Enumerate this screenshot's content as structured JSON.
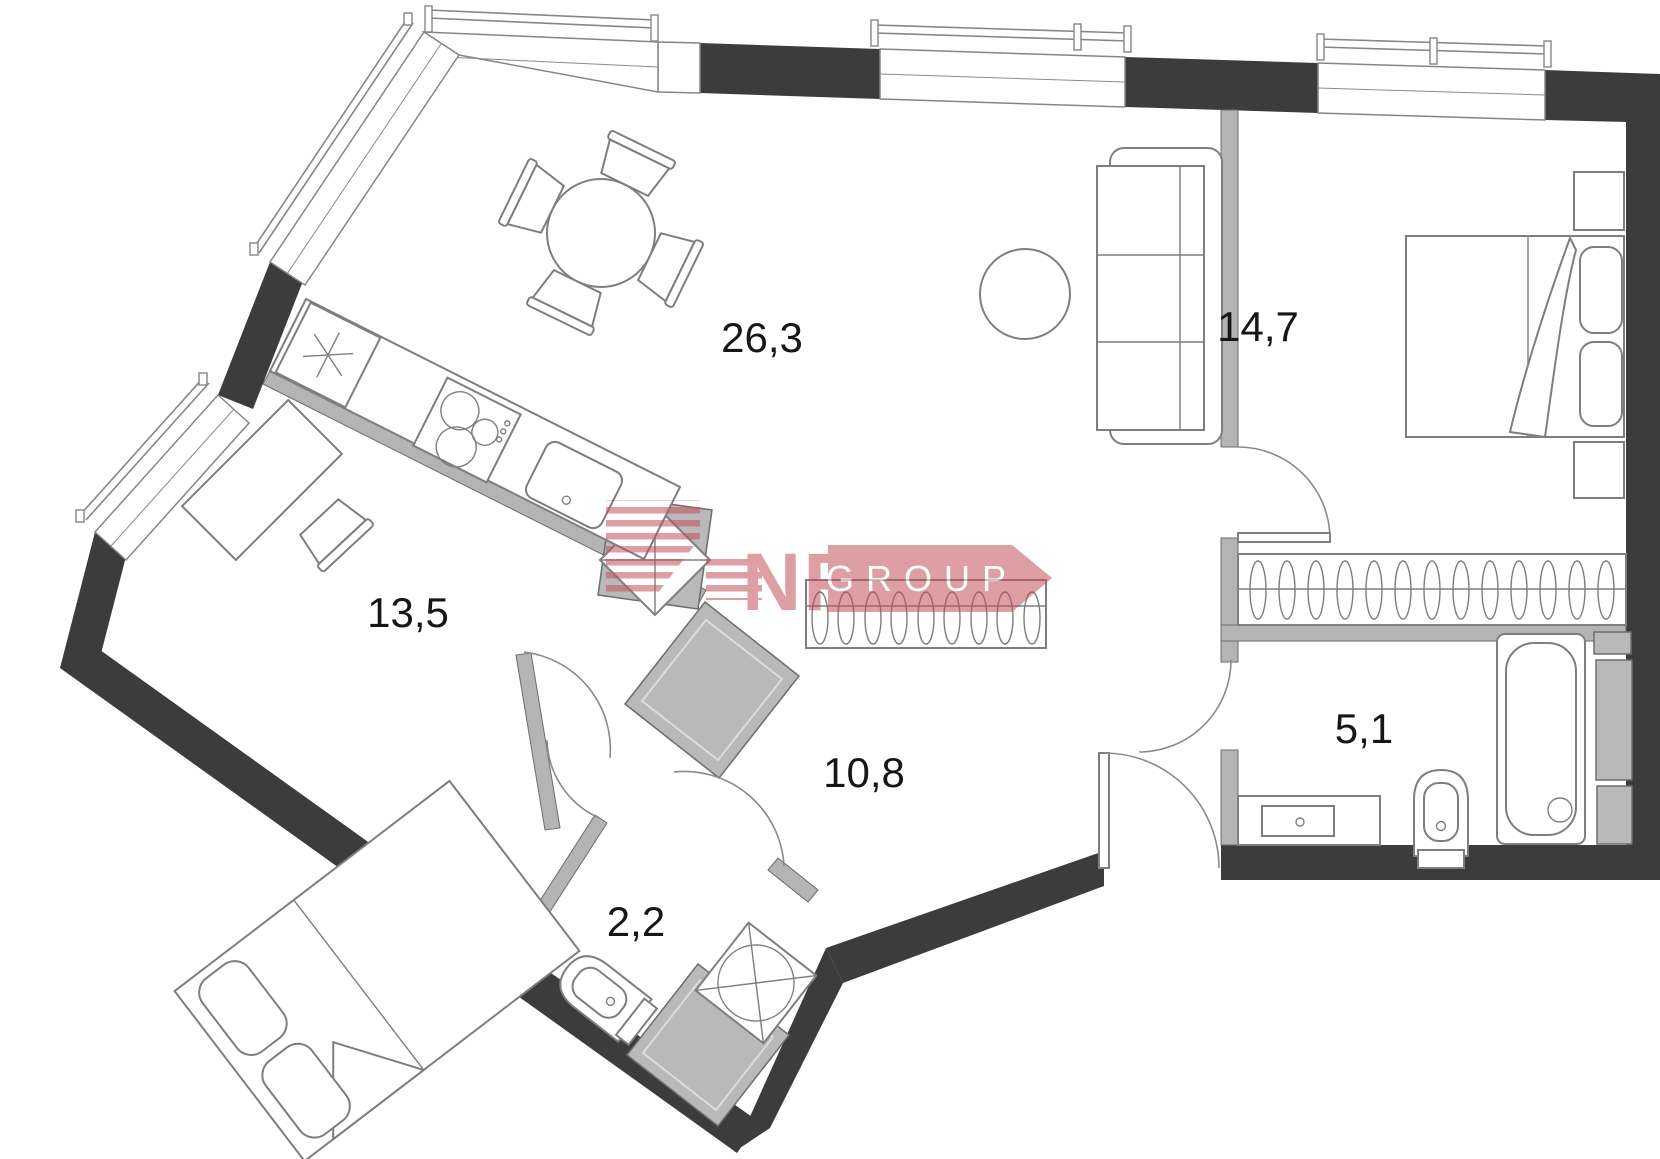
{
  "title": "Apartment floor plan",
  "colors": {
    "wall": "#3c3c3c",
    "partition": "#b4b4b4",
    "furniture_line": "#7e7e7e",
    "label": "#161616",
    "logo_pink": "#c2505a",
    "logo_text": "#ffffff"
  },
  "rooms": [
    {
      "name": "living-kitchen",
      "area_label": "26,3"
    },
    {
      "name": "bedroom",
      "area_label": "14,7"
    },
    {
      "name": "bedroom-second",
      "area_label": "13,5"
    },
    {
      "name": "hallway",
      "area_label": "10,8"
    },
    {
      "name": "bathroom",
      "area_label": "5,1"
    },
    {
      "name": "wc",
      "area_label": "2,2"
    }
  ],
  "watermark": {
    "letters": "NF",
    "banner_text": "GROUP"
  }
}
